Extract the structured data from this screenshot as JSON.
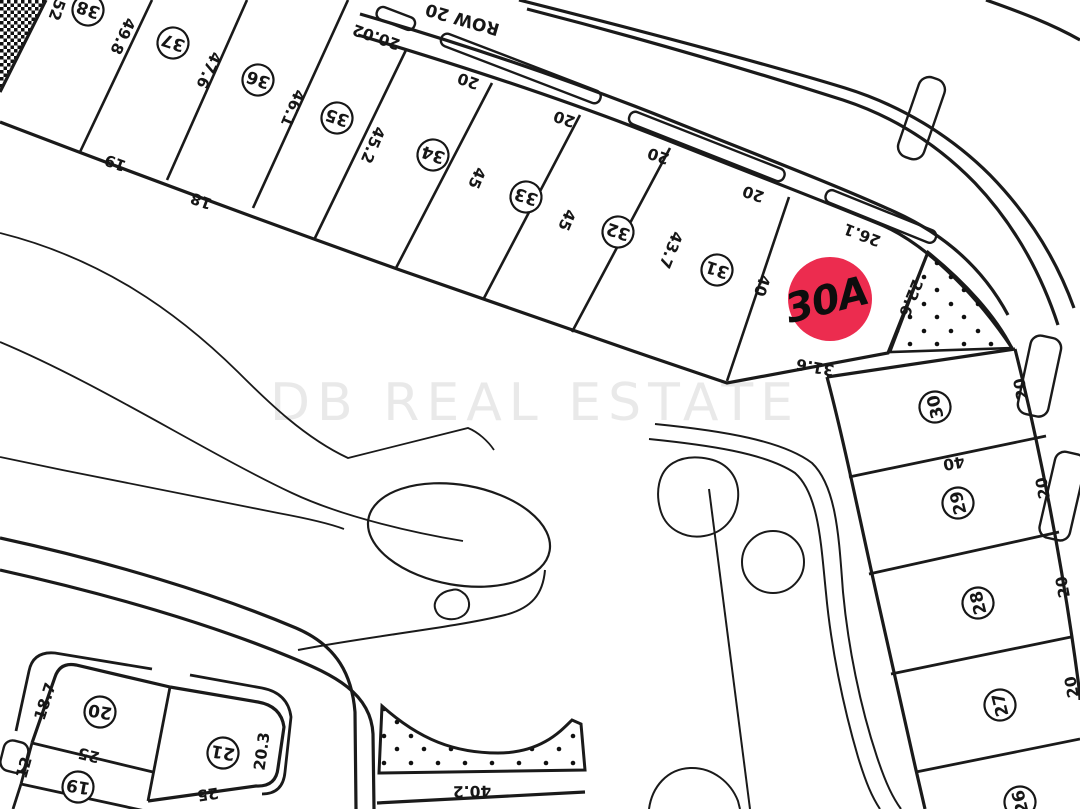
{
  "map": {
    "watermark": "DB REAL ESTATE",
    "row_label": "ROW 20",
    "badge": {
      "label": "30A",
      "color": "#EC2C4F"
    },
    "colors": {
      "line": "#1a1a1a",
      "badge": "#EC2C4F",
      "watermark": "#e9e9e9"
    }
  },
  "lot_numbers": {
    "n38": "38",
    "n37": "37",
    "n36": "36",
    "n35": "35",
    "n34": "34",
    "n33": "33",
    "n32": "32",
    "n31": "31",
    "n30": "30",
    "n29": "29",
    "n28": "28",
    "n27": "27",
    "n26": "26",
    "n20": "20",
    "n21": "21",
    "n19": "19"
  },
  "dimensions": {
    "d52": "52",
    "d49_8": "49.8",
    "d47_6": "47.6",
    "d46_1": "46.1",
    "d45_2": "45.2",
    "d45_a": "45",
    "d45_b": "45",
    "d43_7": "43.7",
    "d40_side": "40",
    "f19": "19",
    "f18": "18",
    "s20_02": "20.02",
    "s20_a": "20",
    "s20_b": "20",
    "s20_c": "20",
    "s20_d": "20",
    "a26_1": "26.1",
    "a22_6": "22.6",
    "a31_6": "31.6",
    "r20_a": "20",
    "r20_b": "20",
    "r20_c": "20",
    "r20_d": "20",
    "r40": "40",
    "b18_7": "18.7",
    "b25_a": "25",
    "b12": "12",
    "b25_b": "25",
    "b20_3": "20.3",
    "b40_2": "40.2"
  }
}
